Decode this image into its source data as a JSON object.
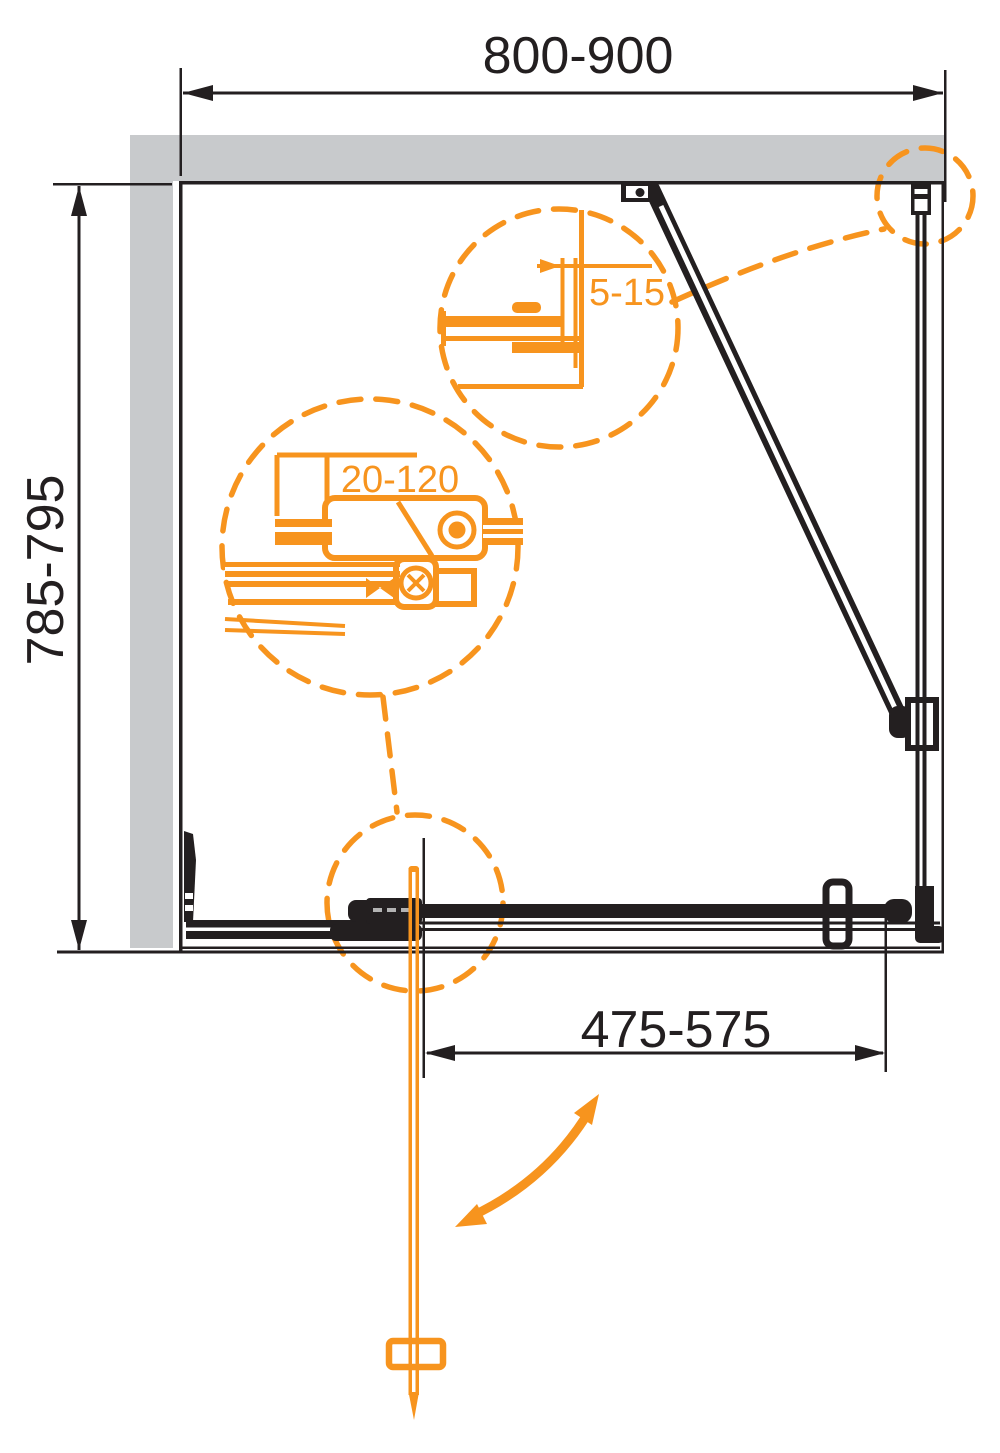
{
  "diagram": {
    "title": "shower-enclosure-plan-technical-drawing",
    "dimensions": {
      "width_top": "800-900",
      "depth_left": "785-795",
      "door_opening_bottom": "475-575",
      "wall_profile_adjustment": "5-15",
      "bracket_adjustment": "20-120"
    },
    "callouts": [
      {
        "name": "wall-profile-detail",
        "label": "5-15"
      },
      {
        "name": "adjustment-bracket-detail",
        "label": "20-120"
      },
      {
        "name": "door-pivot-detail",
        "label": ""
      },
      {
        "name": "corner-connection-detail",
        "label": ""
      }
    ],
    "colors": {
      "accent_orange": "#F7941E",
      "line_black": "#231F20",
      "wall_gray": "#C8CACC",
      "rail_dash_gray": "#B3B3B3",
      "background": "#FFFFFF"
    }
  }
}
